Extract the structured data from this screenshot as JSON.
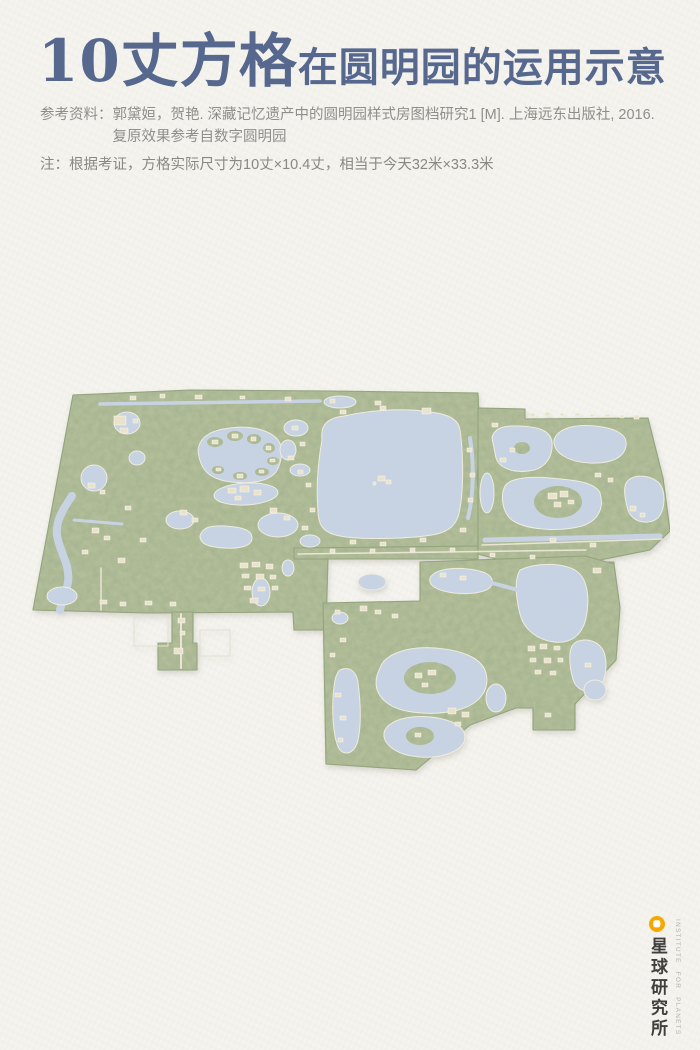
{
  "page": {
    "background_color": "#f4f2ed"
  },
  "header": {
    "title_primary": "10丈方格",
    "title_secondary": "在圆明园的运用示意",
    "title_color": "#56688e",
    "reference_label": "参考资料：",
    "reference_line1": "郭黛姮，贺艳. 深藏记忆遗产中的圆明园样式房图档研究1 [M]. 上海远东出版社, 2016.",
    "reference_line2": "复原效果参考自数字圆明园",
    "note": "注：根据考证，方格实际尺寸为10丈×10.4丈，相当于今天32米×33.3米"
  },
  "map": {
    "description": "圆明园复原鸟瞰平面图",
    "colors": {
      "land": "#b3bf9a",
      "vegetation": "#869b6c",
      "water": "#c7d3e2",
      "building": "#eae3cb",
      "path": "#e9e5d5"
    }
  },
  "footer_logo": {
    "icon": "planet-icon",
    "accent_color": "#f6a800",
    "brand_cn": "星球研究所",
    "brand_en": "INSTITUTE FOR PLANETS",
    "text_color": "#403f3c"
  }
}
